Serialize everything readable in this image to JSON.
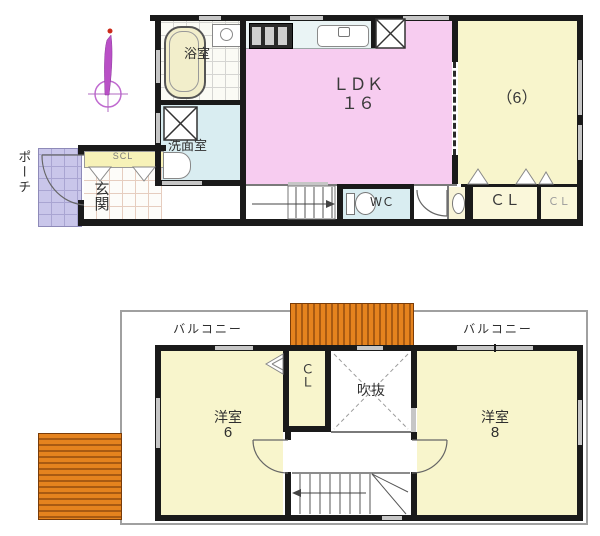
{
  "title": "floor plan",
  "floor1": {
    "porch": "ポーチ",
    "entrance": "玄関",
    "shoe_closet": "SCL",
    "bathroom": "浴室",
    "washroom": "洗面室",
    "ldk_name": "ＬＤＫ",
    "ldk_size": "１６",
    "tatami_room": "（6）",
    "wc": "ＷＣ",
    "closet_large": "ＣＬ",
    "closet_small": "ＣＬ"
  },
  "floor2": {
    "balcony_left": "バルコニー",
    "balcony_right": "バルコニー",
    "bedroom_left_name": "洋室",
    "bedroom_left_size": "6",
    "bedroom_right_name": "洋室",
    "bedroom_right_size": "8",
    "closet": "ＣＬ",
    "void": "吹抜"
  },
  "colors": {
    "ldk_pink": "#f7ccf0",
    "room_yellow": "#f8f5cc",
    "closet_yellow": "#faf7da",
    "wet_cyan": "#d9edf1",
    "porch_lavender": "#c9c6ea",
    "scl_yellow": "#f7f2b8",
    "roof_orange": "#e5831e",
    "wall_black": "#1a1a1a",
    "window_gray": "#c6c6c6",
    "compass_magenta": "#b94fc6"
  }
}
